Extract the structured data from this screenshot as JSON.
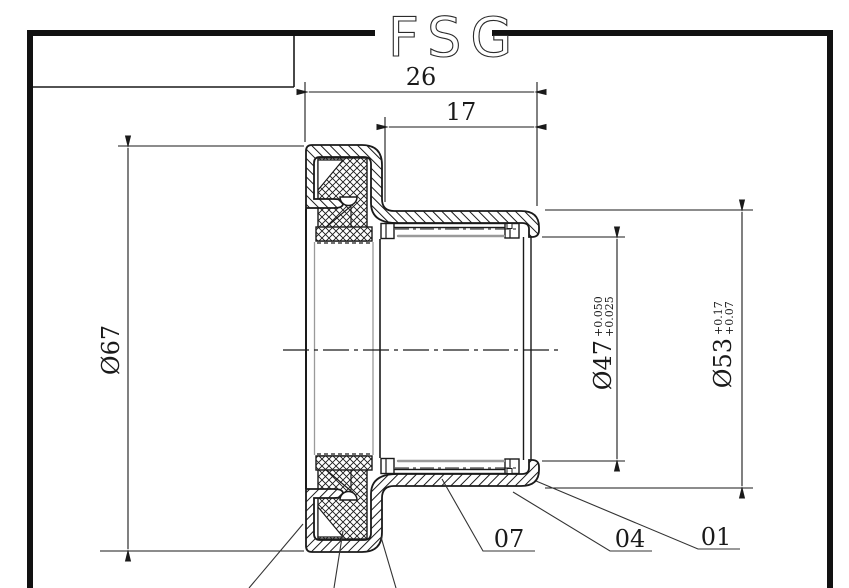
{
  "drawing": {
    "logo_text": "FSG",
    "dimensions": {
      "overall_width": "26",
      "sleeve_width": "17",
      "outer_diameter": "Ø67",
      "bore": {
        "value": "Ø47",
        "tol_upper": "+0.050",
        "tol_lower": "+0.025"
      },
      "sleeve_od": {
        "value": "Ø53",
        "tol_upper": "+0.17",
        "tol_lower": "+0.07"
      }
    },
    "callouts": [
      {
        "label": "07"
      },
      {
        "label": "04"
      },
      {
        "label": "01"
      }
    ],
    "colors": {
      "line": "#1a1a1a",
      "tangent_line": "#9a9a9a",
      "background": "#ffffff"
    }
  }
}
